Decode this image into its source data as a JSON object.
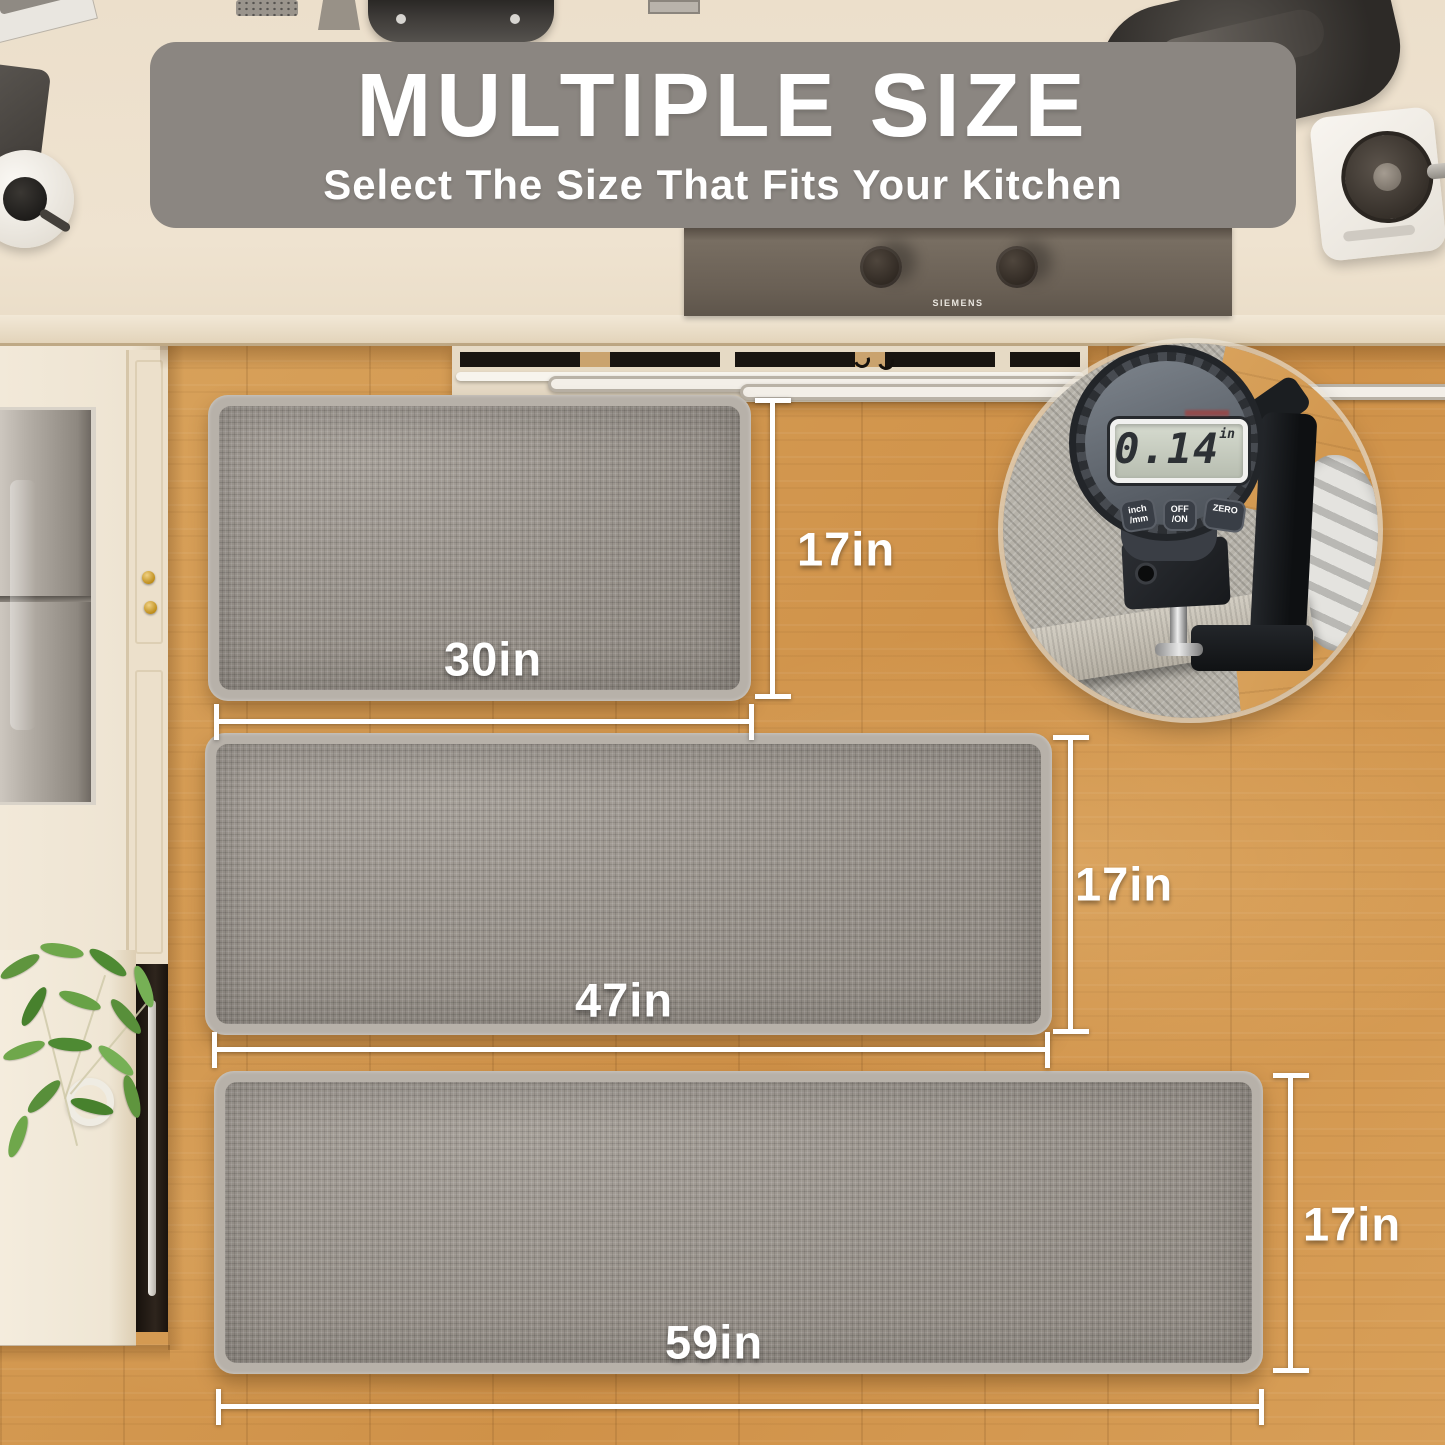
{
  "banner": {
    "title": "MULTIPLE SIZE",
    "subtitle": "Select The Size That Fits Your Kitchen"
  },
  "mats": [
    {
      "name": "mat-30in",
      "width_label": "30in",
      "height_label": "17in"
    },
    {
      "name": "mat-47in",
      "width_label": "47in",
      "height_label": "17in"
    },
    {
      "name": "mat-59in",
      "width_label": "59in",
      "height_label": "17in"
    }
  ],
  "thickness_gauge": {
    "reading": "0.14",
    "unit": "in",
    "buttons": [
      {
        "line1": "inch",
        "line2": "/mm"
      },
      {
        "line1": "OFF",
        "line2": "/ON"
      },
      {
        "line1": "ZERO",
        "line2": ""
      }
    ]
  },
  "cooktop_brand": "SIEMENS",
  "colors": {
    "banner_bg": "#8b8681",
    "mat_surface": "#97918a",
    "mat_binding": "#b7b1a9",
    "floor_wood": "#d49a52",
    "counter_cream": "#eee2cf",
    "dimension_marks": "#ffffff"
  }
}
